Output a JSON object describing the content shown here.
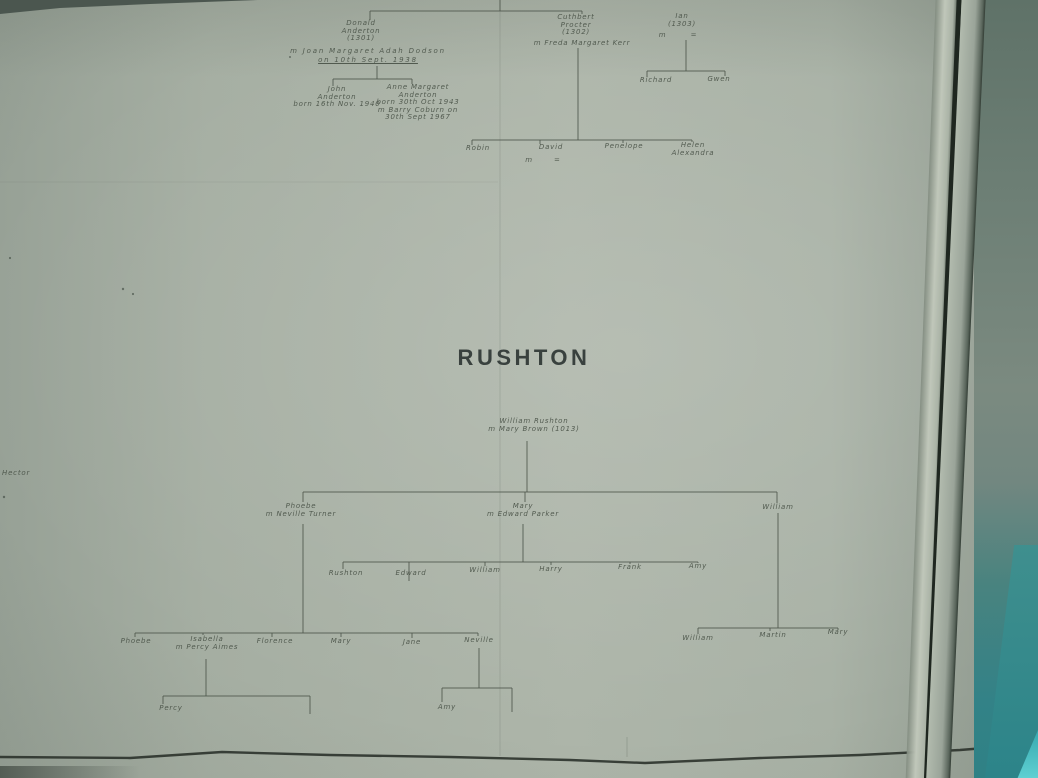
{
  "margin_note": "Hector",
  "colors": {
    "paper": "#a9b2a6",
    "ink": "#4a5348",
    "title_ink": "#39413e",
    "adjacent_surface": "#6d7f75",
    "teal_accent": "#2c8489",
    "cyan_sliver": "#5fd0d2"
  },
  "trees": {
    "anderton": {
      "donald": {
        "name1": "Donald",
        "name2": "Anderton",
        "id": "(1301)",
        "marriage1": "m Joan Margaret Adah Dodson",
        "marriage2": "on 10th Sept. 1938"
      },
      "john": {
        "name1": "John",
        "name2": "Anderton",
        "born": "born 16th Nov. 1940"
      },
      "anne": {
        "name1": "Anne Margaret",
        "name2": "Anderton",
        "born": "born 30th Oct 1943",
        "marriage1": "m Barry Coburn on",
        "marriage2": "30th Sept 1967"
      },
      "cuthbert": {
        "name1": "Cuthbert",
        "name2": "Procter",
        "id": "(1302)",
        "marriage1": "m Freda Margaret Kerr"
      },
      "ian": {
        "name1": "Ian",
        "id": "(1303)",
        "marriage1": "m        ="
      },
      "richard": "Richard",
      "gwen": "Gwen",
      "robin": "Robin",
      "david": "David",
      "david_marriage": "m       =",
      "penelope": "Penelope",
      "helen1": "Helen",
      "helen2": "Alexandra"
    },
    "rushton": {
      "title": "RUSHTON",
      "william_mary1": "William Rushton",
      "william_mary2": "m Mary Brown (1013)",
      "phoebe1": "Phoebe",
      "phoebe2": "m Neville Turner",
      "mary1": "Mary",
      "mary2": "m Edward Parker",
      "william": "William",
      "children_of_mary": [
        "Rushton",
        "Edward",
        "William",
        "Harry",
        "Frank",
        "Amy"
      ],
      "children_of_phoebe": [
        "Phoebe",
        "Isabella",
        "Florence",
        "Mary",
        "Jane",
        "Neville"
      ],
      "isabella_marriage": "m Percy Aimes",
      "children_of_william": [
        "William",
        "Martin",
        "Mary"
      ],
      "percy": "Percy",
      "amy": "Amy"
    }
  }
}
